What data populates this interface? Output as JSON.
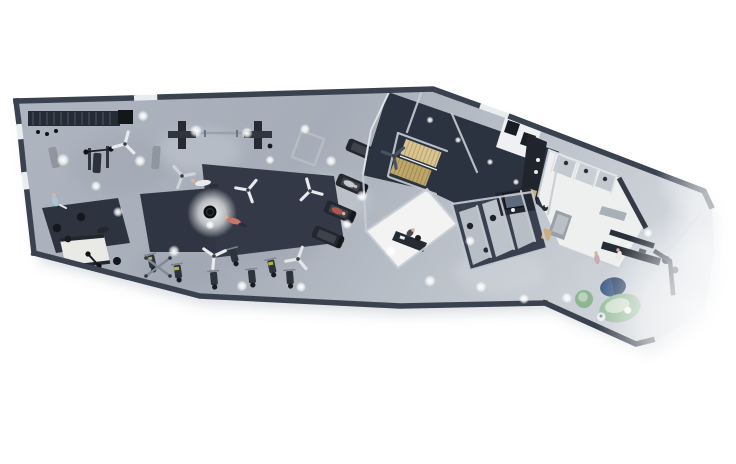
{
  "meta": {
    "description": "3D rendered top-down floor plan of a fitness gym studio with training hall, locker rooms, offices and reception lounge",
    "view": "top-down axonometric render",
    "background": "#ffffff"
  },
  "palette": {
    "bg": "#ffffff",
    "wall": "#3a4250",
    "wallLight": "#c6ccd4",
    "window": "#e9edf0",
    "floor1": "#b6bcc6",
    "floor2": "#a3aab6",
    "roomDark": "#2b3240",
    "matDark": "#333947",
    "equip": "#272c34",
    "steel": "#b6bcc4",
    "whiteRoom": "#eef0f0",
    "stallFloor": "#b8bec6",
    "stairLight": "#d8c58f",
    "stairDark": "#bfa76a",
    "locker": "#20252d",
    "monitor": "#5d6b7d",
    "desk": "#262c35",
    "rugBlue": "#49648c",
    "rugBlueDark": "#3d5273",
    "sofaGreen": "#9cbfa1",
    "sofaCushion": "#cfe0cd",
    "poufGreen": "#8fb593",
    "skin": "#d9b49a",
    "shirtRed": "#b0584c",
    "shirtBlue": "#a9c4d6",
    "woodBench": "#c9b083",
    "accentYellow": "#b5b148",
    "shadow": "#bdc4cd"
  },
  "rooms": [
    {
      "name": "gym-training-hall"
    },
    {
      "name": "stair-hall"
    },
    {
      "name": "back-rooms"
    },
    {
      "name": "office"
    },
    {
      "name": "consultation-stalls"
    },
    {
      "name": "admin-desk-room"
    },
    {
      "name": "shower-area"
    },
    {
      "name": "changing-room"
    },
    {
      "name": "reception-lounge"
    }
  ],
  "equipment": [
    {
      "name": "wall-mounted-rig"
    },
    {
      "name": "weight-bench"
    },
    {
      "name": "bench-press-station"
    },
    {
      "name": "cable-tower-pair-with-barbell-rack"
    },
    {
      "name": "power-rack-frames"
    },
    {
      "name": "treadmill-row"
    },
    {
      "name": "strength-machine-row"
    },
    {
      "name": "cable-cross-machine"
    },
    {
      "name": "slam-ball-mat"
    },
    {
      "name": "lifting-platform-with-barbell"
    },
    {
      "name": "training-mats"
    }
  ],
  "furniture": [
    {
      "name": "reception-desk"
    },
    {
      "name": "back-counter"
    },
    {
      "name": "office-desk"
    },
    {
      "name": "computer-monitor"
    },
    {
      "name": "round-blue-rug"
    },
    {
      "name": "green-curved-sofa"
    },
    {
      "name": "green-pouf"
    },
    {
      "name": "side-table"
    },
    {
      "name": "locker-cabinets"
    },
    {
      "name": "changing-bench"
    }
  ],
  "people": [
    {
      "pose": "lying-on-mat"
    },
    {
      "pose": "exercising-on-mat"
    },
    {
      "pose": "standing-with-dumbbell"
    },
    {
      "pose": "push-up-on-mat"
    },
    {
      "pose": "walking-on-treadmill"
    },
    {
      "pose": "running-on-treadmill"
    },
    {
      "pose": "standing-at-doorway"
    },
    {
      "pose": "sitting-at-office-desk"
    },
    {
      "pose": "standing-at-reception"
    },
    {
      "pose": "standing-in-lounge"
    }
  ],
  "counts": {
    "ceiling_fans": 7,
    "treadmills": 4,
    "strength_machines": 7,
    "shower_stalls": 3,
    "consultation_stalls": 3,
    "slam_balls": 3,
    "stair_flights": 2
  }
}
